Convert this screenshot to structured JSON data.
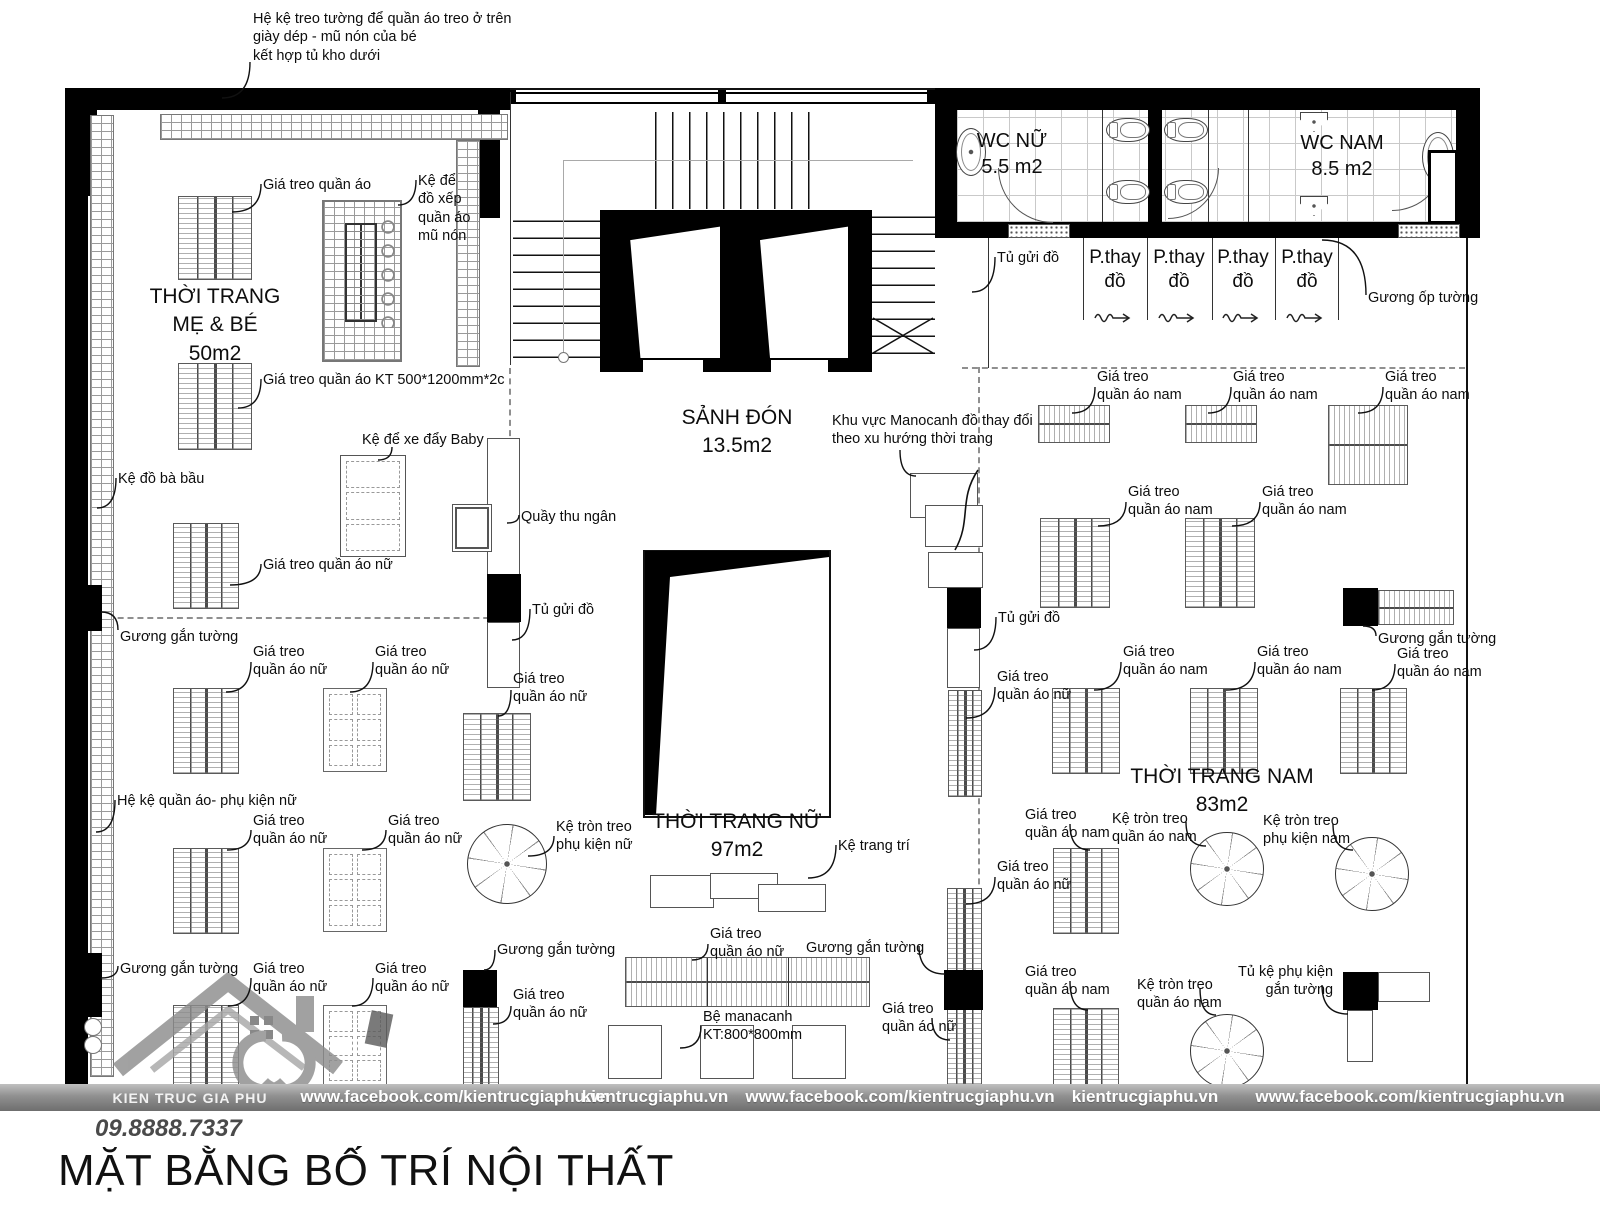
{
  "title": "MẶT BẰNG BỐ TRÍ NỘI THẤT",
  "footer": {
    "brand": "KIEN TRUC GIA PHU",
    "phone": "09.8888.7337",
    "items": [
      "www.facebook.com/kientrucgiaphu.vn",
      "kientrucgiaphu.vn",
      "www.facebook.com/kientrucgiaphu.vn",
      "kientrucgiaphu.vn",
      "www.facebook.com/kientrucgiaphu.vn"
    ]
  },
  "rooms": {
    "me_be": {
      "name": "THỜI TRANG MẸ & BÉ",
      "area": "50m2"
    },
    "sanh_don": {
      "name": "SẢNH ĐÓN",
      "area": "13.5m2"
    },
    "nu": {
      "name": "THỜI TRANG NỮ",
      "area": "97m2"
    },
    "nam": {
      "name": "THỜI TRANG NAM",
      "area": "83m2"
    },
    "wc_nu": {
      "name": "WC NỮ",
      "area": "5.5 m2"
    },
    "wc_nam": {
      "name": "WC NAM",
      "area": "8.5 m2"
    }
  },
  "callouts": [
    {
      "name": "note-wall-shelf",
      "text": "Hệ kệ treo tường để quần áo treo ở trên\ngiày dép - mũ nón của bé\n kết hợp tủ kho dưới",
      "x": 253,
      "y": 10,
      "leader": [
        250,
        62,
        222,
        98
      ]
    },
    {
      "name": "label-gia-treo-quan-ao",
      "text": "Giá treo quần áo",
      "x": 263,
      "y": 176,
      "leader": [
        261,
        184,
        232,
        212
      ]
    },
    {
      "name": "label-ke-de-do-xep",
      "text": "Kệ để\nđồ xếp\nquần áo\nmũ nón",
      "x": 418,
      "y": 172,
      "leader": [
        416,
        180,
        398,
        205
      ]
    },
    {
      "name": "room-thoi-trang-me-be",
      "cls": "room",
      "ctr": 1,
      "text": "THỜI TRANG\nMẸ & BÉ\n50m2",
      "x": 215,
      "y": 283
    },
    {
      "name": "label-gia-treo-kt",
      "text": "Giá treo quần áo KT 500*1200mm*2c",
      "x": 263,
      "y": 371,
      "leader": [
        261,
        379,
        238,
        408
      ]
    },
    {
      "name": "label-ke-do-ba-bau",
      "text": "Kệ đồ bà bầu",
      "x": 118,
      "y": 470,
      "leader": [
        116,
        478,
        97,
        508
      ]
    },
    {
      "name": "label-ke-xe-day-baby",
      "text": "Kệ để xe  đẩy Baby",
      "x": 362,
      "y": 431,
      "leader": [
        392,
        447,
        378,
        460
      ]
    },
    {
      "name": "label-quay-thu-ngan",
      "text": "Quầy thu ngân",
      "x": 521,
      "y": 508,
      "leader": [
        519,
        515,
        507,
        523
      ]
    },
    {
      "name": "label-gia-treo-nu-1",
      "text": "Giá treo quần áo nữ",
      "x": 263,
      "y": 556,
      "leader": [
        261,
        564,
        230,
        585
      ]
    },
    {
      "name": "label-guong-gan-tuong-1",
      "text": "Gương gắn tường",
      "x": 120,
      "y": 628,
      "leader": [
        118,
        630,
        101,
        612
      ]
    },
    {
      "name": "label-tu-gui-do-1",
      "text": "Tủ gửi đồ",
      "x": 532,
      "y": 601,
      "leader": [
        530,
        609,
        512,
        640
      ]
    },
    {
      "name": "label-gia-treo-nu-2",
      "text": "Giá treo\nquần áo nữ",
      "x": 253,
      "y": 643,
      "leader": [
        251,
        662,
        226,
        692
      ]
    },
    {
      "name": "label-gia-treo-nu-3",
      "text": "Giá treo\nquần áo nữ",
      "x": 375,
      "y": 643,
      "leader": [
        373,
        662,
        350,
        692
      ]
    },
    {
      "name": "label-gia-treo-nu-4",
      "text": "Giá treo\nquần áo nữ",
      "x": 513,
      "y": 670,
      "leader": [
        511,
        690,
        498,
        716
      ]
    },
    {
      "name": "label-he-ke-phu-kien-nu",
      "text": "Hệ kệ quần áo- phụ kiện nữ",
      "x": 117,
      "y": 792,
      "leader": [
        115,
        800,
        96,
        832
      ]
    },
    {
      "name": "label-gia-treo-nu-5",
      "text": "Giá treo\nquần áo nữ",
      "x": 253,
      "y": 812,
      "leader": [
        251,
        830,
        227,
        850
      ]
    },
    {
      "name": "label-gia-treo-nu-6",
      "text": "Giá treo\nquần áo nữ",
      "x": 388,
      "y": 812,
      "leader": [
        386,
        830,
        362,
        850
      ]
    },
    {
      "name": "label-ke-tron-phu-kien-nu",
      "text": "Kệ tròn treo\nphụ kiện nữ",
      "x": 556,
      "y": 818,
      "leader": [
        554,
        836,
        528,
        856
      ]
    },
    {
      "name": "label-guong-gan-tuong-2",
      "text": "Gương gắn tường",
      "x": 120,
      "y": 960,
      "leader": [
        118,
        966,
        101,
        978
      ]
    },
    {
      "name": "label-gia-treo-nu-7",
      "text": "Giá treo\nquần áo nữ",
      "x": 253,
      "y": 960,
      "leader": [
        251,
        978,
        228,
        1006
      ]
    },
    {
      "name": "label-gia-treo-nu-8",
      "text": "Giá treo\nquần áo nữ",
      "x": 375,
      "y": 960,
      "leader": [
        373,
        978,
        352,
        1006
      ]
    },
    {
      "name": "label-guong-gan-tuong-3",
      "text": "Gương gắn tường",
      "x": 497,
      "y": 941,
      "leader": [
        495,
        950,
        484,
        970
      ]
    },
    {
      "name": "label-gia-treo-nu-9",
      "text": "Giá treo\nquần áo nữ",
      "x": 513,
      "y": 986,
      "leader": [
        511,
        1006,
        493,
        1024
      ]
    },
    {
      "name": "room-sanh-don",
      "cls": "room",
      "ctr": 1,
      "text": "SẢNH ĐÓN\n13.5m2",
      "x": 737,
      "y": 404
    },
    {
      "name": "note-manocanh",
      "text": "Khu vực Manocanh đồ thay đổi\ntheo xu hướng thời trang",
      "x": 832,
      "y": 412,
      "leader": [
        900,
        450,
        916,
        476
      ]
    },
    {
      "name": "room-thoi-trang-nu",
      "cls": "room",
      "ctr": 1,
      "text": "THỜI TRANG NỮ\n97m2",
      "x": 737,
      "y": 808
    },
    {
      "name": "label-ke-trang-tri",
      "text": "Kệ  trang trí",
      "x": 838,
      "y": 837,
      "leader": [
        836,
        845,
        808,
        878
      ]
    },
    {
      "name": "label-gia-treo-nu-10",
      "text": "Giá treo\nquần áo nữ",
      "x": 710,
      "y": 925,
      "leader": [
        708,
        944,
        692,
        960
      ]
    },
    {
      "name": "label-guong-gan-tuong-4",
      "text": "Gương gắn tường",
      "x": 806,
      "y": 939,
      "leader": [
        919,
        946,
        945,
        974
      ]
    },
    {
      "name": "label-be-manacanh",
      "text": "Bệ manacanh\nKT:800*800mm",
      "x": 703,
      "y": 1008,
      "leader": [
        701,
        1026,
        680,
        1048
      ]
    },
    {
      "name": "label-gia-treo-nu-11",
      "text": "Giá treo\nquần áo nữ",
      "x": 882,
      "y": 1000,
      "leader": [
        932,
        1018,
        950,
        1040
      ]
    },
    {
      "name": "label-tu-gui-do-2",
      "text": "Tủ gửi đồ",
      "x": 997,
      "y": 249,
      "leader": [
        995,
        257,
        972,
        292
      ]
    },
    {
      "name": "label-guong-op-tuong",
      "text": "Gương ốp tường",
      "x": 1368,
      "y": 289,
      "leader": [
        1366,
        295,
        1322,
        240
      ]
    },
    {
      "name": "label-gia-treo-nam-1",
      "text": "Giá treo\nquần áo nam",
      "x": 1097,
      "y": 368,
      "leader": [
        1095,
        387,
        1072,
        413
      ]
    },
    {
      "name": "label-gia-treo-nam-2",
      "text": "Giá treo\nquần áo nam",
      "x": 1233,
      "y": 368,
      "leader": [
        1231,
        387,
        1208,
        413
      ]
    },
    {
      "name": "label-gia-treo-nam-3",
      "text": "Giá treo\nquần áo nam",
      "x": 1385,
      "y": 368,
      "leader": [
        1383,
        387,
        1358,
        413
      ]
    },
    {
      "name": "label-gia-treo-nam-4",
      "text": "Giá treo\nquần áo nam",
      "x": 1128,
      "y": 483,
      "leader": [
        1126,
        502,
        1098,
        526
      ]
    },
    {
      "name": "label-gia-treo-nam-5",
      "text": "Giá treo\nquần áo nam",
      "x": 1262,
      "y": 483,
      "leader": [
        1260,
        502,
        1232,
        526
      ]
    },
    {
      "name": "label-tu-gui-do-3",
      "text": "Tủ gửi đồ",
      "x": 998,
      "y": 609,
      "leader": [
        996,
        617,
        974,
        650
      ]
    },
    {
      "name": "label-gia-treo-nu-12",
      "text": "Giá treo\nquần áo nữ",
      "x": 997,
      "y": 668,
      "leader": [
        995,
        687,
        966,
        718
      ]
    },
    {
      "name": "label-gia-treo-nam-6",
      "text": "Giá treo\nquần áo nam",
      "x": 1123,
      "y": 643,
      "leader": [
        1121,
        662,
        1094,
        690
      ]
    },
    {
      "name": "label-gia-treo-nam-7",
      "text": "Giá treo\nquần áo nam",
      "x": 1257,
      "y": 643,
      "leader": [
        1255,
        662,
        1226,
        690
      ]
    },
    {
      "name": "label-guong-gan-tuong-5",
      "text": "Gương gắn tường",
      "x": 1378,
      "y": 630,
      "leader": [
        1376,
        636,
        1363,
        626
      ]
    },
    {
      "name": "label-gia-treo-nam-8",
      "text": "Giá treo\nquần áo nam",
      "x": 1397,
      "y": 645,
      "leader": [
        1395,
        664,
        1372,
        690
      ]
    },
    {
      "name": "room-thoi-trang-nam",
      "cls": "room",
      "ctr": 1,
      "text": "THỜI TRANG NAM\n83m2",
      "x": 1222,
      "y": 763
    },
    {
      "name": "label-gia-treo-nam-9",
      "text": "Giá treo\nquần áo nam",
      "x": 1025,
      "y": 806,
      "leader": [
        1070,
        824,
        1090,
        850
      ]
    },
    {
      "name": "label-ke-tron-nam-1",
      "text": "Kệ tròn treo\nquần áo nam",
      "x": 1112,
      "y": 810,
      "leader": [
        1186,
        822,
        1206,
        846
      ]
    },
    {
      "name": "label-ke-tron-phu-kien-nam",
      "text": "Kệ tròn treo\nphụ kiện nam",
      "x": 1263,
      "y": 812,
      "leader": [
        1333,
        824,
        1353,
        850
      ]
    },
    {
      "name": "label-gia-treo-nu-13",
      "text": "Giá treo\nquần áo nữ",
      "x": 997,
      "y": 858,
      "leader": [
        995,
        877,
        966,
        904
      ]
    },
    {
      "name": "label-gia-treo-nam-10",
      "text": "Giá treo\nquần áo nam",
      "x": 1025,
      "y": 963,
      "leader": [
        1070,
        981,
        1088,
        1010
      ]
    },
    {
      "name": "label-ke-tron-nam-2",
      "text": "Kệ tròn treo\nquần áo nam",
      "x": 1137,
      "y": 976,
      "leader": [
        1200,
        988,
        1216,
        1015
      ]
    },
    {
      "name": "label-tu-ke-phu-kien",
      "text": "Tủ kệ phụ kiện\ngắn tường",
      "align": "right",
      "x": 1238,
      "y": 963,
      "leader": [
        1322,
        985,
        1348,
        1014
      ]
    },
    {
      "name": "room-wc-nu",
      "cls": "wc",
      "ctr": 1,
      "text": "WC NỮ\n5.5 m2",
      "x": 1012,
      "y": 128
    },
    {
      "name": "room-wc-nam",
      "cls": "wc",
      "ctr": 1,
      "text": "WC NAM\n8.5 m2",
      "x": 1342,
      "y": 130
    },
    {
      "name": "label-fitting-room-1",
      "cls": "fit",
      "ctr": 1,
      "text": "P.thay\nđồ",
      "x": 1115,
      "y": 246
    },
    {
      "name": "label-fitting-room-2",
      "cls": "fit",
      "ctr": 1,
      "text": "P.thay\nđồ",
      "x": 1179,
      "y": 246
    },
    {
      "name": "label-fitting-room-3",
      "cls": "fit",
      "ctr": 1,
      "text": "P.thay\nđồ",
      "x": 1243,
      "y": 246
    },
    {
      "name": "label-fitting-room-4",
      "cls": "fit",
      "ctr": 1,
      "text": "P.thay\nđồ",
      "x": 1307,
      "y": 246
    }
  ]
}
